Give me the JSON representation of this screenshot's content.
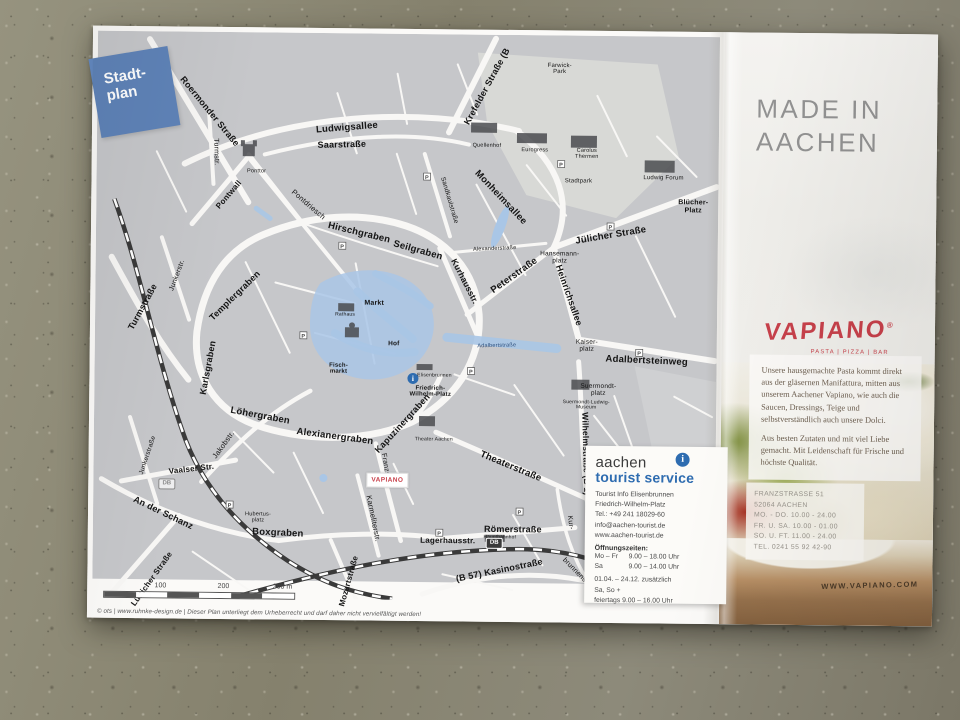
{
  "map": {
    "tag": {
      "line1": "Stadt-",
      "line2": "plan"
    },
    "vapiano_marker": "VAPIANO",
    "db": "DB",
    "info_i": "i",
    "scale": {
      "t100": "100",
      "t200": "200",
      "t300": "300 m"
    },
    "copyright": "© ots | www.ruhnke-design.de | Dieser Plan unterliegt dem Urheberrecht und darf daher nicht vervielfältigt werden!",
    "labels": [
      {
        "t": "Roermonder Straße",
        "x": 112,
        "y": 80,
        "r": 50,
        "s": 9,
        "w": 700
      },
      {
        "t": "Ludwigsallee",
        "x": 250,
        "y": 95,
        "r": -5,
        "s": 9.5,
        "w": 700
      },
      {
        "t": "Saarstraße",
        "x": 245,
        "y": 112,
        "r": -2,
        "s": 9,
        "w": 700
      },
      {
        "t": "Krefelder Straße (B",
        "x": 390,
        "y": 52,
        "r": -62,
        "s": 9,
        "w": 700
      },
      {
        "t": "Turmstr.",
        "x": 119,
        "y": 120,
        "r": 88,
        "s": 7,
        "w": 400
      },
      {
        "t": "Pontwall",
        "x": 133,
        "y": 163,
        "r": -50,
        "s": 8,
        "w": 700
      },
      {
        "t": "Ponttor",
        "x": 160,
        "y": 140,
        "r": 0,
        "s": 5.5,
        "w": 400
      },
      {
        "t": "Turmstraße",
        "x": 48,
        "y": 276,
        "r": -62,
        "s": 9,
        "w": 700
      },
      {
        "t": "Junkerstr.",
        "x": 82,
        "y": 244,
        "r": -70,
        "s": 7,
        "w": 400
      },
      {
        "t": "Templergraben",
        "x": 140,
        "y": 264,
        "r": -45,
        "s": 9,
        "w": 700
      },
      {
        "t": "Karlsgraben",
        "x": 114,
        "y": 336,
        "r": -80,
        "s": 9,
        "w": 700
      },
      {
        "t": "Pontdriesch",
        "x": 212,
        "y": 172,
        "r": 40,
        "s": 7.5,
        "w": 400
      },
      {
        "t": "Hirschgraben",
        "x": 263,
        "y": 200,
        "r": 13,
        "s": 9.5,
        "w": 700
      },
      {
        "t": "Seilgraben",
        "x": 322,
        "y": 217,
        "r": 15,
        "s": 9.5,
        "w": 700
      },
      {
        "t": "Kurhausstr.",
        "x": 369,
        "y": 247,
        "r": 62,
        "s": 8.5,
        "w": 700
      },
      {
        "t": "Sandkaulstraße",
        "x": 353,
        "y": 166,
        "r": 73,
        "s": 6.5,
        "w": 400
      },
      {
        "t": "Monheimsallee",
        "x": 404,
        "y": 163,
        "r": 46,
        "s": 9.5,
        "w": 700
      },
      {
        "t": "Farwick-\nPark",
        "x": 462,
        "y": 34,
        "r": 0,
        "s": 6,
        "w": 400
      },
      {
        "t": "Eurogress",
        "x": 438,
        "y": 116,
        "r": 0,
        "s": 5.5,
        "w": 400
      },
      {
        "t": "Quellenhof",
        "x": 390,
        "y": 112,
        "r": 0,
        "s": 5.5,
        "w": 400
      },
      {
        "t": "Carolus\nThermen",
        "x": 490,
        "y": 119,
        "r": 0,
        "s": 5.5,
        "w": 400
      },
      {
        "t": "Stadtpark",
        "x": 482,
        "y": 146,
        "r": 0,
        "s": 6,
        "w": 400
      },
      {
        "t": "Ludwig Forum",
        "x": 567,
        "y": 142,
        "r": 0,
        "s": 6,
        "w": 400
      },
      {
        "t": "Blücher-\nPlatz",
        "x": 597,
        "y": 170,
        "r": 0,
        "s": 7,
        "w": 700
      },
      {
        "t": "Jülicher Straße",
        "x": 515,
        "y": 200,
        "r": -10,
        "s": 9.5,
        "w": 700
      },
      {
        "t": "Hansemann-\nplatz",
        "x": 464,
        "y": 222,
        "r": 0,
        "s": 6.5,
        "w": 400
      },
      {
        "t": "Heinrichsallee",
        "x": 473,
        "y": 260,
        "r": 70,
        "s": 9,
        "w": 700
      },
      {
        "t": "Peterstraße",
        "x": 419,
        "y": 241,
        "r": -36,
        "s": 9.5,
        "w": 700
      },
      {
        "t": "Kaiser-\nplatz",
        "x": 492,
        "y": 310,
        "r": 0,
        "s": 6.5,
        "w": 400
      },
      {
        "t": "Adalbertsteinweg",
        "x": 552,
        "y": 325,
        "r": 2,
        "s": 9.5,
        "w": 700
      },
      {
        "t": "Adalbertstraße",
        "x": 402,
        "y": 312,
        "r": -2,
        "s": 5.5,
        "w": 400,
        "c": "#2d4f7d"
      },
      {
        "t": "Alexanderstraße",
        "x": 399,
        "y": 215,
        "r": -3,
        "s": 5.5,
        "w": 400
      },
      {
        "t": "Wilhelmstraße (B 1)",
        "x": 492,
        "y": 418,
        "r": 88,
        "s": 8.5,
        "w": 700
      },
      {
        "t": "Suermondt-\nplatz",
        "x": 504,
        "y": 354,
        "r": 0,
        "s": 6.5,
        "w": 400
      },
      {
        "t": "Suermondt-Ludwig-\nMuseum",
        "x": 492,
        "y": 370,
        "r": 0,
        "s": 5,
        "w": 400
      },
      {
        "t": "Markt",
        "x": 279,
        "y": 270,
        "r": 0,
        "s": 7,
        "w": 700
      },
      {
        "t": "Rathaus",
        "x": 250,
        "y": 282,
        "r": 0,
        "s": 5,
        "w": 400
      },
      {
        "t": "Hof",
        "x": 299,
        "y": 310,
        "r": 0,
        "s": 6.5,
        "w": 700
      },
      {
        "t": "Fisch-\nmarkt",
        "x": 244,
        "y": 336,
        "r": 0,
        "s": 6,
        "w": 700
      },
      {
        "t": "Elisenbrunnen",
        "x": 340,
        "y": 342,
        "r": 0,
        "s": 5,
        "w": 400
      },
      {
        "t": "Friedrich-\nWilhelm-Platz",
        "x": 336,
        "y": 358,
        "r": 0,
        "s": 6,
        "w": 700
      },
      {
        "t": "Theaterstraße",
        "x": 417,
        "y": 432,
        "r": 22,
        "s": 9.5,
        "w": 700
      },
      {
        "t": "Theater Aachen",
        "x": 340,
        "y": 406,
        "r": 0,
        "s": 5,
        "w": 400
      },
      {
        "t": "Kapuzinergraben",
        "x": 309,
        "y": 390,
        "r": -48,
        "s": 9,
        "w": 700
      },
      {
        "t": "Alexianergraben",
        "x": 241,
        "y": 404,
        "r": 7,
        "s": 9.5,
        "w": 700
      },
      {
        "t": "Löhergraben",
        "x": 166,
        "y": 384,
        "r": 10,
        "s": 9.5,
        "w": 700
      },
      {
        "t": "Franzstr.",
        "x": 292,
        "y": 434,
        "r": 80,
        "s": 7,
        "w": 400
      },
      {
        "t": "Karmeliterstr.",
        "x": 280,
        "y": 485,
        "r": 78,
        "s": 7.5,
        "w": 400
      },
      {
        "t": "Boxgraben",
        "x": 185,
        "y": 501,
        "r": 2,
        "s": 9.5,
        "w": 700
      },
      {
        "t": "Hubertus-\nplatz",
        "x": 165,
        "y": 486,
        "r": 0,
        "s": 5.5,
        "w": 400
      },
      {
        "t": "An der Schanz",
        "x": 70,
        "y": 482,
        "r": 25,
        "s": 9,
        "w": 700
      },
      {
        "t": "Vaalser Str.",
        "x": 98,
        "y": 438,
        "r": -7,
        "s": 8,
        "w": 700
      },
      {
        "t": "Jakobstr.",
        "x": 130,
        "y": 413,
        "r": -55,
        "s": 7.5,
        "w": 400
      },
      {
        "t": "Junkerstraße",
        "x": 54,
        "y": 424,
        "r": -72,
        "s": 6.5,
        "w": 400
      },
      {
        "t": "Lütticher Straße",
        "x": 60,
        "y": 548,
        "r": -55,
        "s": 8,
        "w": 700
      },
      {
        "t": "Mozartstraße",
        "x": 257,
        "y": 548,
        "r": -75,
        "s": 8,
        "w": 700
      },
      {
        "t": "Lagerhausstr.",
        "x": 355,
        "y": 507,
        "r": 0,
        "s": 8,
        "w": 700
      },
      {
        "t": "Römerstraße",
        "x": 420,
        "y": 495,
        "r": 0,
        "s": 9,
        "w": 700
      },
      {
        "t": "Hauptbahnhof",
        "x": 407,
        "y": 503,
        "r": 0,
        "s": 4.8,
        "w": 400
      },
      {
        "t": "(B 57) Kasinostraße",
        "x": 407,
        "y": 536,
        "r": -12,
        "s": 9,
        "w": 700
      },
      {
        "t": "Kur-",
        "x": 477,
        "y": 487,
        "r": 82,
        "s": 7,
        "w": 400
      },
      {
        "t": "brunnenstr.",
        "x": 484,
        "y": 537,
        "r": 45,
        "s": 7,
        "w": 400
      }
    ]
  },
  "tourist_box": {
    "brand_top": "aachen",
    "brand_bottom": "tourist service",
    "i_glyph": "i",
    "lines": [
      "Tourist Info Elisenbrunnen",
      "Friedrich-Wilhelm-Platz",
      "Tel.: +49 241 18029-60",
      "info@aachen-tourist.de",
      "www.aachen-tourist.de"
    ],
    "hours_title": "Öffnungszeiten:",
    "hours": [
      [
        "Mo – Fr",
        "9.00 – 18.00 Uhr"
      ],
      [
        "Sa",
        "9.00 – 14.00 Uhr"
      ]
    ],
    "extra": [
      "01.04. – 24.12. zusätzlich",
      "Sa, So +",
      "feiertags   9.00 – 16.00 Uhr"
    ]
  },
  "ad": {
    "headline_line1": "MADE IN",
    "headline_line2": "AACHEN",
    "logo": "VAPIANO",
    "logo_reg": "®",
    "tagline": "PASTA  |  PIZZA  |  BAR",
    "body1": "Unsere hausgemachte Pasta kommt direkt aus der gläsernen Manifattura, mitten aus unserem Aachener Vapiano, wie auch die Saucen, Dressings, Teige und selbstverständlich auch unsere Dolci.",
    "body2": "Aus besten Zutaten und mit viel Liebe gemacht. Mit Leidenschaft für Frische und höchste Qualität.",
    "address": [
      "FRANZSTRASSE 51",
      "52064 AACHEN",
      "MO. - DO.   10.00 - 24.00",
      "FR. U. SA.   10.00 - 01.00",
      "SO. U. FT.   11.00 - 24.00",
      "TEL.    0241 55 92 42-90"
    ],
    "website": "WWW.VAPIANO.COM"
  },
  "colors": {
    "accent_red": "#c8414b",
    "brand_blue": "#2e6cb0",
    "tag_blue": "#5f83b8",
    "pedestrian_blue": "#a9c6e6"
  }
}
